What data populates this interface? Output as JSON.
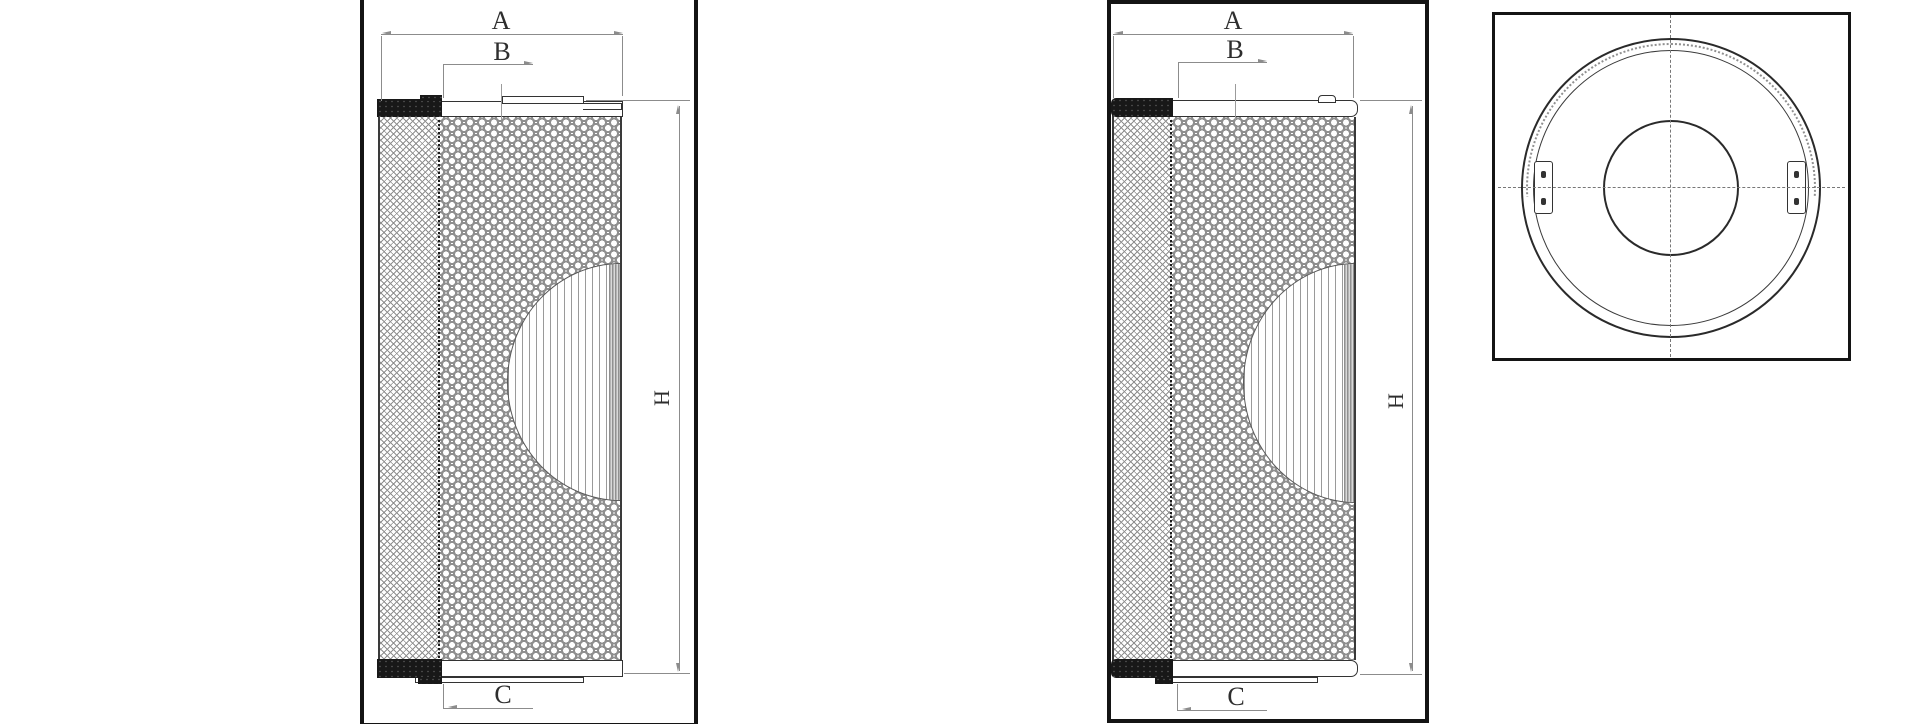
{
  "colors": {
    "frame_border": "#141414",
    "drawing_line": "#333333",
    "dimension_line": "#8c8c8c",
    "label_text": "#2e2e2e",
    "pattern_gray": "#8f8f8f",
    "end_cap_fill": "#181818",
    "background": "#ffffff"
  },
  "view1": {
    "label_a": "A",
    "label_b": "B",
    "label_c": "C",
    "label_h": "H"
  },
  "view2": {
    "label_a": "A",
    "label_b": "B",
    "label_c": "C",
    "label_h": "H"
  }
}
